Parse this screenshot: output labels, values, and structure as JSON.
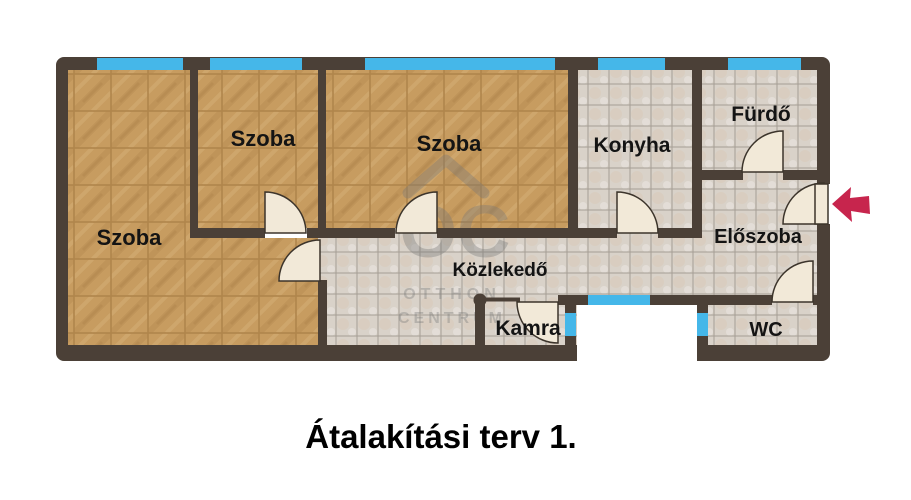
{
  "title": "Átalakítási terv 1.",
  "watermark": {
    "monogram": "OC",
    "line1": "OTTHON",
    "line2": "CENTRUM"
  },
  "rooms": {
    "szoba_large": {
      "label": "Szoba"
    },
    "szoba_middle": {
      "label": "Szoba"
    },
    "szoba_right": {
      "label": "Szoba"
    },
    "konyha": {
      "label": "Konyha"
    },
    "furdo": {
      "label": "Fürdő"
    },
    "eloszoba": {
      "label": "Előszoba"
    },
    "kozlekedo": {
      "label": "Közlekedő"
    },
    "kamra": {
      "label": "Kamra"
    },
    "wc": {
      "label": "WC"
    }
  },
  "icons": {
    "entrance_arrow": "left-arrow"
  },
  "colors": {
    "wall": "#4b4037",
    "window_blue": "#45b7e9",
    "wood_floor": "#c79c60",
    "wood_line": "#b0854b",
    "tile_floor": "#d9d2c9",
    "tile_line": "#a59e95",
    "door_leaf": "#f2e9d8",
    "door_outline": "#3c342b",
    "entrance_arrow": "#c7254d",
    "watermark_gray": "#787878",
    "title_text": "#000000"
  }
}
